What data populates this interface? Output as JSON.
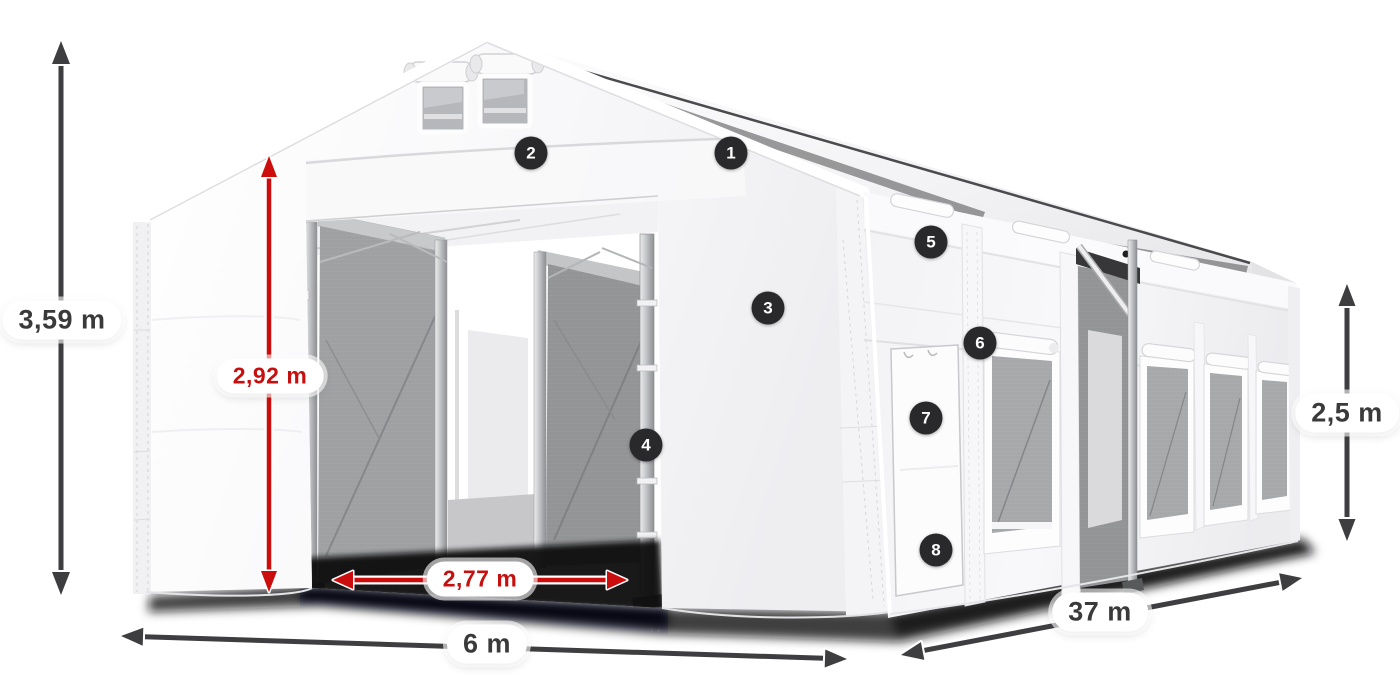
{
  "colors": {
    "background": "#ffffff",
    "dimension_arrow_dark": "#3e3e40",
    "dimension_arrow_red": "#cc0d0d",
    "dimension_text_dark": "#3a3a3a",
    "dimension_text_red": "#c6100f",
    "label_pill_background": "#ffffff",
    "callout_background": "#29292b",
    "callout_text": "#ffffff",
    "tent_canvas": "#ffffff",
    "mesh_panel": "#a2a3a5"
  },
  "dimensions": {
    "total_height": {
      "value": "3,59 m"
    },
    "inner_door_height": {
      "value": "2,92 m"
    },
    "inner_door_width": {
      "value": "2,77 m"
    },
    "width": {
      "value": "6 m"
    },
    "length": {
      "value": "37 m"
    },
    "side_wall_height": {
      "value": "2,5 m"
    }
  },
  "callouts": [
    "1",
    "2",
    "3",
    "4",
    "5",
    "6",
    "7",
    "8"
  ]
}
